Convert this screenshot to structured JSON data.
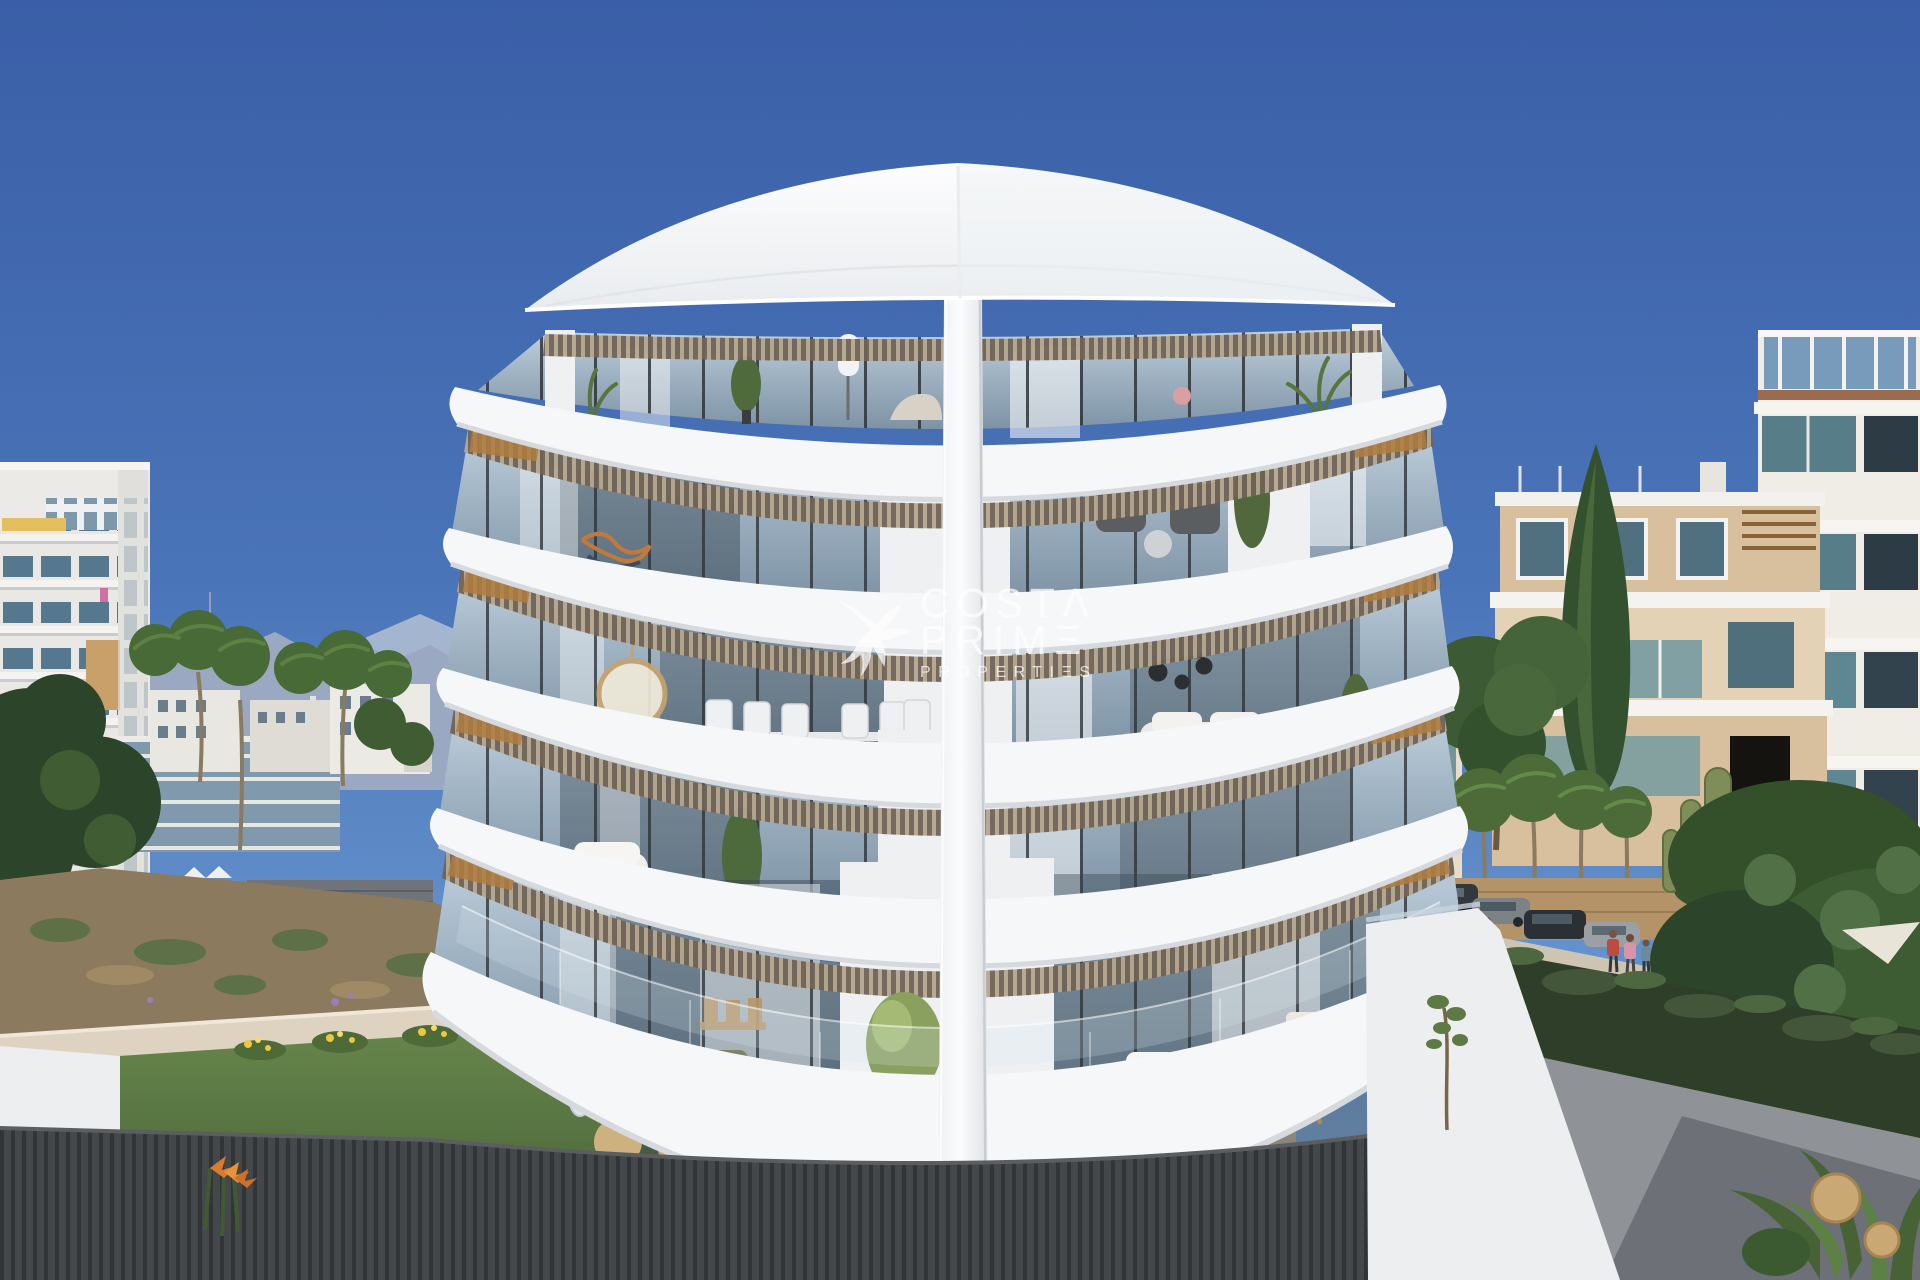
{
  "image": {
    "kind": "real-estate architectural rendering (photo-style)",
    "description": "Modern curved white apartment building with five stacked balcony decks and glass facade, viewed from the street in a Mediterranean beach town. Blue sky, mountains and white apartment towers to the left, cream apartment blocks, street with parked cars, pedestrians, hedge and trees to the right, dry garden with lawn, beige wall and dark slat fence in the foreground.",
    "width_px": 1920,
    "height_px": 1280
  },
  "watermark": {
    "brand": "Costa Prime Properties",
    "text": "COSTA PRIME PROPERTIES",
    "line1": {
      "text": "COSTA",
      "display": "COSTΛ"
    },
    "line2": {
      "text": "PRIME",
      "display": "PRIMΞ"
    },
    "line3": {
      "text": "PROPERTIES",
      "display": "PROPERTIΞS"
    },
    "logo": "hummingbird",
    "color": "#ffffff",
    "opacity": 0.74
  },
  "scene": {
    "sky": {
      "top": "#3a5fa8",
      "mid": "#4f7cbd",
      "horizon": "#8fb3de"
    },
    "main_building": {
      "floors": 5,
      "balcony_decks": 5,
      "style": "curved white concrete decks, peaked curved roof, glass sliding doors, wood-slat soffits, central white pillar",
      "terrace_furniture": [
        "rattan armchairs",
        "round rattan poufs",
        "potted plants",
        "wooden dining table",
        "white sofa",
        "tripod floor lamp",
        "hanging egg chair",
        "ceiling fan"
      ]
    },
    "left_background": [
      "white apartment tower with balconies",
      "yellow awning",
      "mountain ridge with antenna",
      "palm trees",
      "low white buildings",
      "glass mid-rise",
      "stone wall",
      "white umbrellas",
      "dry scrub slope",
      "beige retaining wall",
      "green lawn",
      "yellow flowers",
      "orange bird-of-paradise flowers",
      "dark slat fence"
    ],
    "right_background": [
      "cream apartment block with tan walls",
      "teal glass balconies",
      "tall building with blue glass roof railing",
      "street lamp",
      "tan street wall",
      "palm trees",
      "tall cypress and pine",
      "candelabra cactus",
      "large tree canopy",
      "parked cars",
      "pedestrians",
      "sidewalk",
      "asphalt driveway",
      "hedge",
      "white boundary wall",
      "sapling",
      "rattan lanterns",
      "white parasol"
    ],
    "street": {
      "parked_cars": 5,
      "pedestrians": 3,
      "street_lamp": true
    },
    "lighting": "bright midday sun, clear sky"
  },
  "palette": {
    "building_white": "#f6f7f8",
    "band_shadow": "#d6dade",
    "glass_top": "#bccbd9",
    "glass_bottom": "#7e93a5",
    "slat_dark": "#6f6355",
    "slat_light": "#b4a58e",
    "wood_accent": "#b07c3f",
    "fence_dark": "#45484b",
    "lawn_green": "#5c7a40",
    "scrub_brown": "#8b7a5e",
    "wall_beige": "#ddd3c2",
    "hedge_green": "#2f3e29",
    "road_grey": "#8f9397",
    "mountain_blue": "#9aa9c1",
    "left_windows": "#56788f",
    "teal_glass": "#46707e",
    "tan_facade": "#d8bf9d",
    "rattan": "#c9a873"
  }
}
